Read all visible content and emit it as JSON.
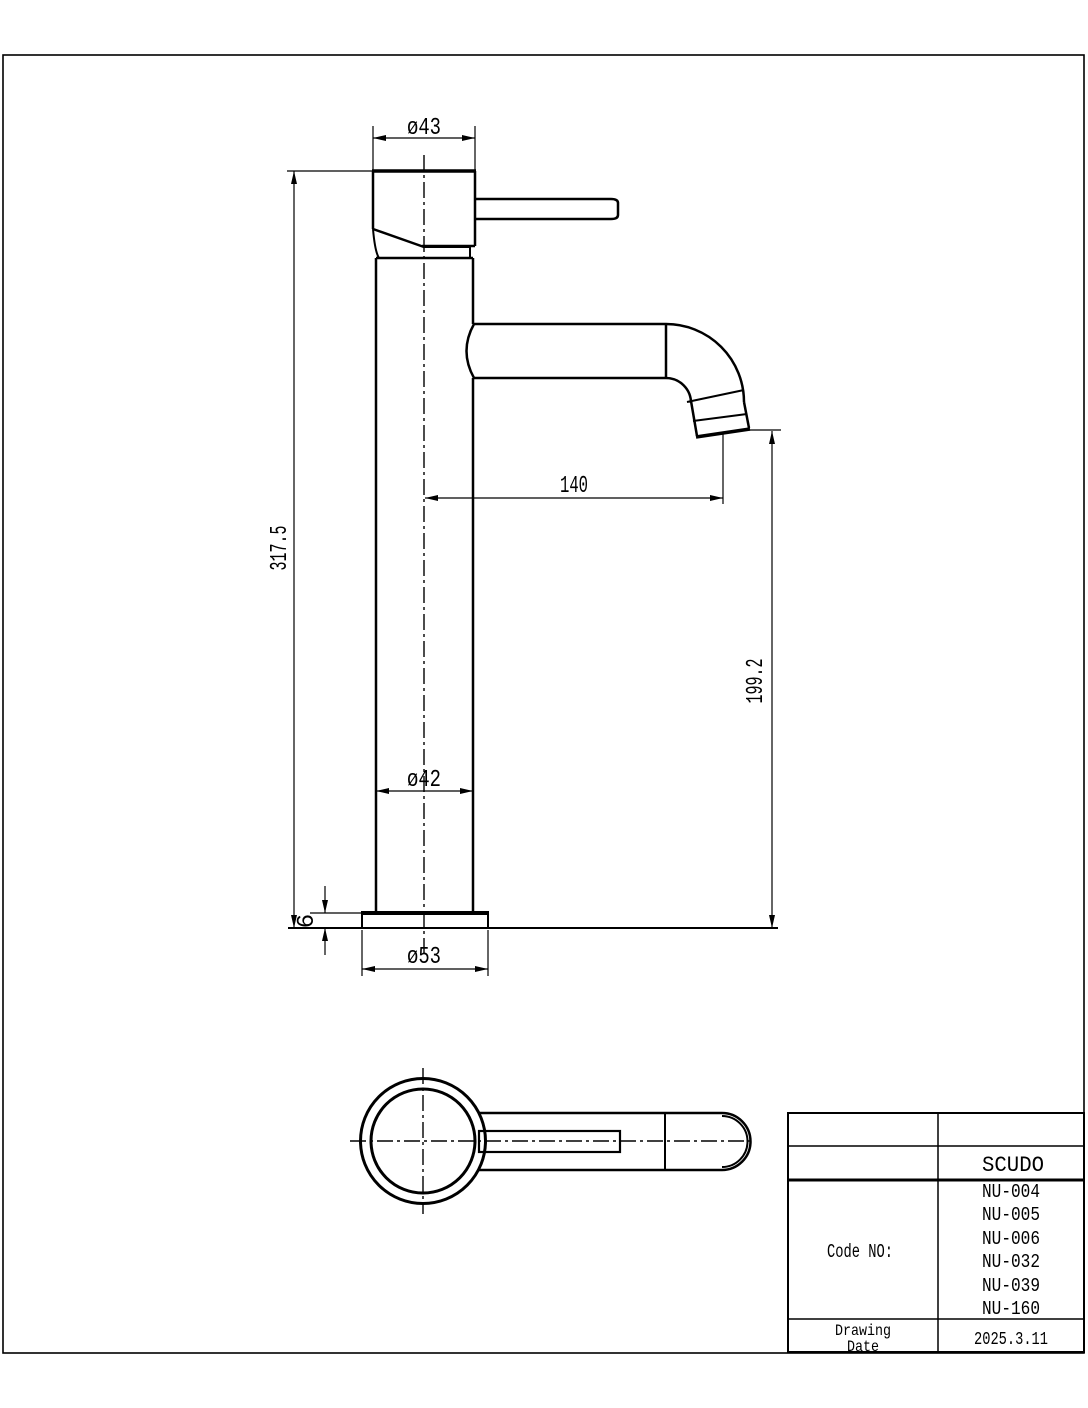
{
  "page": {
    "background_color": "#ffffff",
    "line_color": "#000000"
  },
  "front_view": {
    "dimensions": {
      "top_diameter": "ø43",
      "overall_height": "317.5",
      "spout_reach": "140",
      "spout_outlet_height": "199.2",
      "body_diameter": "ø42",
      "base_thickness": "6",
      "base_diameter": "ø53"
    }
  },
  "title_block": {
    "brand": "SCUDO",
    "code_label": "Code NO:",
    "codes": [
      "NU-004",
      "NU-005",
      "NU-006",
      "NU-032",
      "NU-039",
      "NU-160"
    ],
    "date_label_line1": "Drawing",
    "date_label_line2": "Date",
    "drawing_date": "2025.3.11"
  }
}
